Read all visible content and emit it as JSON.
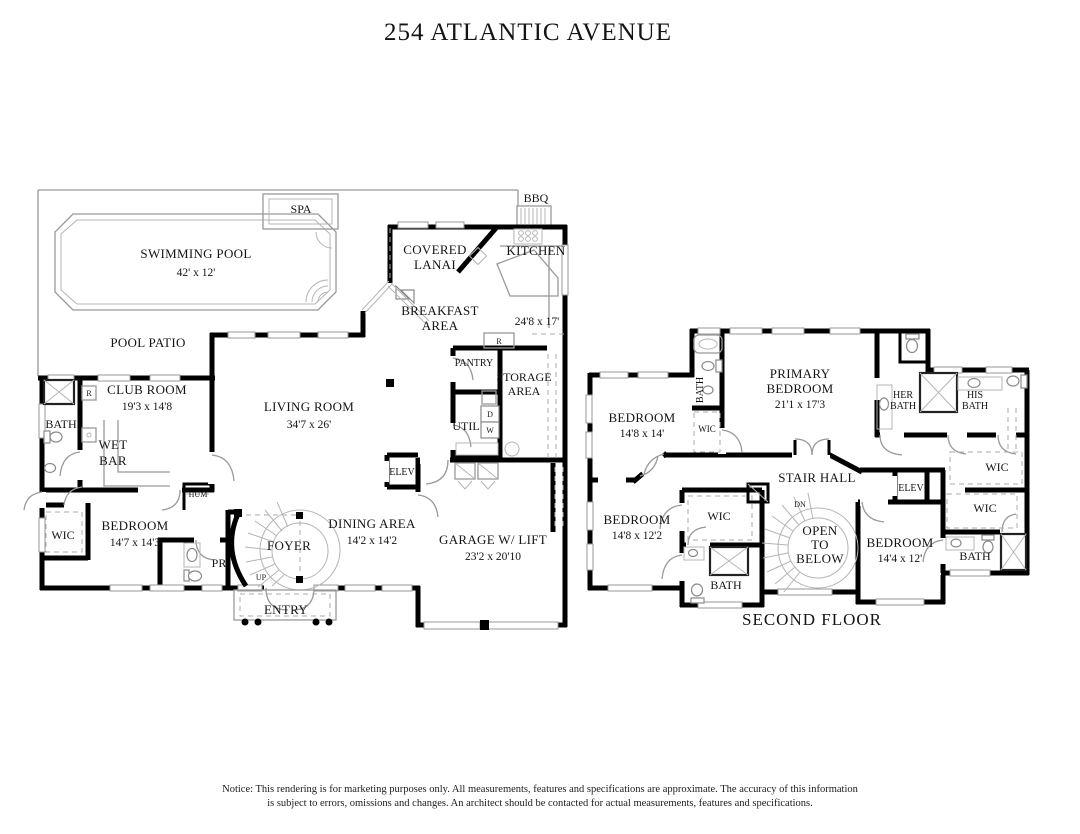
{
  "title": "254 ATLANTIC AVENUE",
  "first_floor": {
    "swimming_pool": {
      "name": "SWIMMING POOL",
      "dims": "42' x 12'"
    },
    "spa": "SPA",
    "pool_patio": "POOL PATIO",
    "bbq": "BBQ",
    "covered_lanai": [
      "COVERED",
      "LANAI"
    ],
    "breakfast_area": [
      "BREAKFAST",
      "AREA"
    ],
    "kitchen": {
      "name": "KITCHEN",
      "dims": "24'8 x 17'"
    },
    "pantry": "PANTRY",
    "storage_area": [
      "STORAGE",
      "AREA"
    ],
    "util": "UTIL",
    "dryer": "D",
    "washer": "W",
    "fridge": "R",
    "fridge2": "R",
    "club_room": {
      "name": "CLUB ROOM",
      "dims": "19'3 x 14'8"
    },
    "bath": "BATH",
    "wet_bar": [
      "WET",
      "BAR"
    ],
    "hum": "HUM",
    "wic": "WIC",
    "bedroom": {
      "name": "BEDROOM",
      "dims": "14'7 x 14'3"
    },
    "powder_room": "PR",
    "foyer": "FOYER",
    "up": "UP",
    "entry": "ENTRY",
    "living_room": {
      "name": "LIVING ROOM",
      "dims": "34'7 x 26'"
    },
    "dining_area": {
      "name": "DINING AREA",
      "dims": "14'2 x 14'2"
    },
    "garage": {
      "name": "GARAGE W/ LIFT",
      "dims": "23'2 x 20'10"
    },
    "elevator": "ELEV"
  },
  "second_floor": {
    "floor_label": "SECOND FLOOR",
    "primary_bedroom": {
      "l1": "PRIMARY",
      "l2": "BEDROOM",
      "dims": "21'1 x 17'3"
    },
    "bedroom_a": {
      "name": "BEDROOM",
      "dims": "14'8 x 14'"
    },
    "bedroom_b": {
      "name": "BEDROOM",
      "dims": "14'8 x 12'2"
    },
    "bedroom_c": {
      "name": "BEDROOM",
      "dims": "14'4 x 12'"
    },
    "bath_top": "BATH",
    "bath_mid": "BATH",
    "bath_right": "BATH",
    "her_bath": [
      "HER",
      "BATH"
    ],
    "his_bath": [
      "HIS",
      "BATH"
    ],
    "wic_a": "WIC",
    "wic_b": "WIC",
    "wic_c": "WIC",
    "wic_d": "WIC",
    "stair_hall": "STAIR HALL",
    "elevator": "ELEV",
    "dn": "DN",
    "open_to_below": [
      "OPEN",
      "TO",
      "BELOW"
    ]
  },
  "notice": {
    "line1": "Notice: This rendering is for marketing purposes only. All measurements, features and specifications are approximate. The accuracy of this information",
    "line2": "is subject to errors, omissions and changes. An architect should be contacted for actual measurements, features and specifications."
  }
}
